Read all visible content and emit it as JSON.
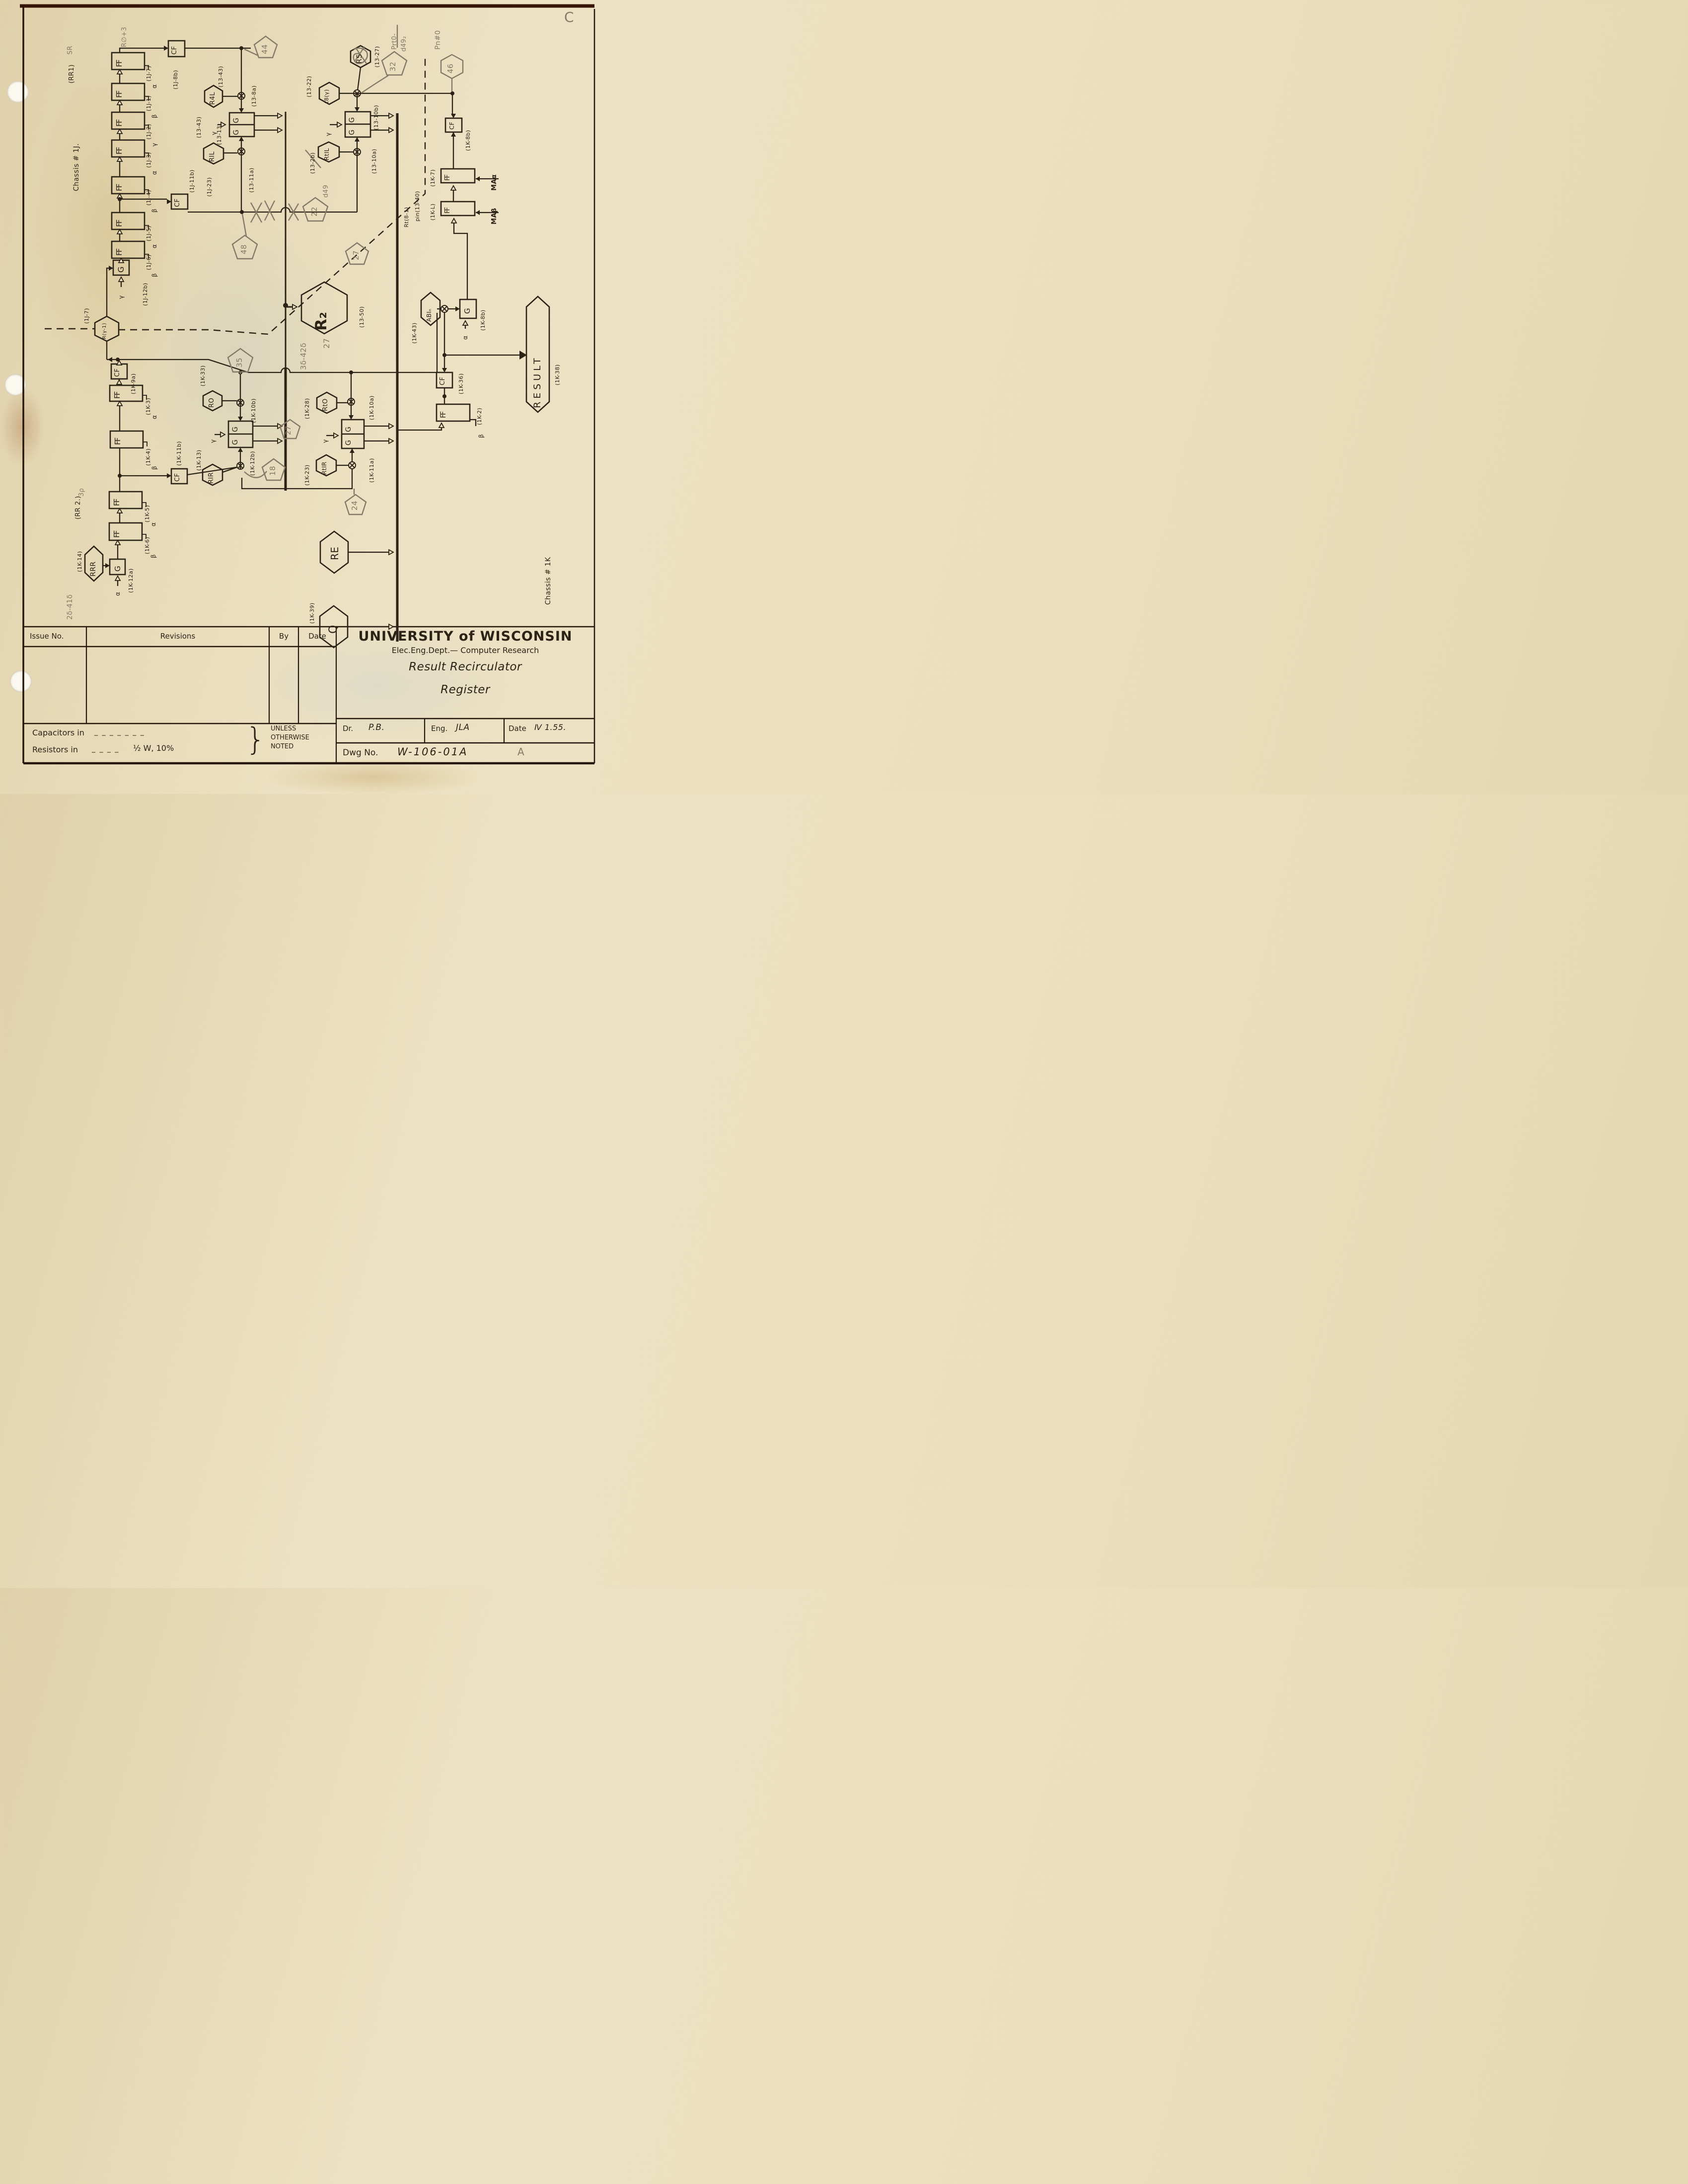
{
  "titleblock": {
    "org": "UNIVERSITY of WISCONSIN",
    "dept": "Elec.Eng.Dept.— Computer Research",
    "title1": "Result Recirculator",
    "title2": "Register",
    "issue": "Issue No.",
    "revisions": "Revisions",
    "by": "By",
    "date_col": "Date",
    "dr_label": "Dr.",
    "dr": "P.B.",
    "eng_label": "Eng.",
    "eng": "JLA",
    "date_label": "Date",
    "date": "Ⅳ 1.55.",
    "dwg_label": "Dwg No.",
    "dwg": "W-106-01A",
    "cap": "Capacitors in",
    "cap_dash": "_ _ _ _ _ _ _",
    "res": "Resistors in",
    "res_dash": "_ _ _ _",
    "res_val": "½ W, 10%",
    "brace": "}",
    "unless": "UNLESS",
    "otherwise": "OTHERWISE",
    "noted": "NOTED"
  },
  "chassis": {
    "top": "Chassis # 1J.",
    "bottom": "Chassis # 1K"
  },
  "blocks": {
    "ff": "FF",
    "cf": "CF",
    "g": "G"
  },
  "greek": {
    "a": "α",
    "b": "β",
    "g": "γ"
  },
  "flags": {
    "r4l": "R4L",
    "ril": "RIL",
    "rs": "RS",
    "t8g": "t8(γ)",
    "rtil": "RtIL",
    "r2": "R₂",
    "rg1": "R(γ-1)",
    "ro": "RO",
    "rir": "RIR",
    "rto": "RtO",
    "rtir": "RtIR",
    "abin": "ABIₙ",
    "rrr": "RRR",
    "re": "RE",
    "q": "Q",
    "result": "RESULT"
  },
  "pins": {
    "a1": "(1J-7)",
    "a2": "(1J-1)",
    "a3": "(1J-2)",
    "a4": "(1J-3)",
    "a5": "(1J-4)",
    "a6": "(1J-5)",
    "a7": "(1J-6)",
    "j8b": "(1J-8b)",
    "j12b": "(1J-12b)",
    "j11b": "(1J-11b)",
    "j23": "(1J-23)",
    "j7": "(1J-7)",
    "p43a": "(13-43)",
    "p43b": "(13-43)",
    "p13": "(13-13)",
    "p8a": "(13-8a)",
    "p11a": "(13-11a)",
    "p22": "(13-22)",
    "p27": "(13-27)",
    "p10b": "(13-10b)",
    "p10a": "(13-10a)",
    "p2b": "(13-2b)",
    "p50": "(13-50)",
    "rt81": "Rt(8-1)",
    "pin1340": "pin(13-40)",
    "k8bcf": "(1K-8b)",
    "k7": "(1K-7)",
    "kl": "(1K-L)",
    "maa": "MAα",
    "mab": "MAβ",
    "k43": "(1K-43)",
    "k8bg": "(1K-8b)",
    "k36": "(1K-36)",
    "k2": "(1K-2)",
    "k38": "(1K-38)",
    "k9a": "(1K-9a)",
    "k33": "(1K-33)",
    "k3": "(1K-3)",
    "k4": "(1K-4)",
    "k11b": "(1K-11b)",
    "k13": "(1K-13)",
    "k5": "(1K-5)",
    "k6": "(1K-6)",
    "k12a": "(1K-12a)",
    "k14": "(1K-14)",
    "k10b": "(1K-10b)",
    "k12b": "(1K-12b)",
    "k10a": "(1K-10a)",
    "k11a": "(1K-11a)",
    "k28": "(1K-28)",
    "k23": "(1K-23)",
    "k39": "(1K-39)",
    "rr1": "(RR1)",
    "rr2": "(RR 2.)"
  },
  "pencil": {
    "sr": "SR",
    "rd3": "R∅+3",
    "n44": "44",
    "n32": "32",
    "prt0": "Prt0-",
    "d492": "d49₂",
    "pn0": "Pn#0",
    "n46": "46",
    "n48": "48",
    "n22": "22",
    "d49": "d49",
    "n27a": "27",
    "n27b": "27",
    "n35": "35",
    "n18": "18",
    "n24": "24",
    "r2n": "27",
    "g3d": "3δ-42δ",
    "g2d": "2δ-41δ",
    "p3r": "3ρ",
    "a": "A",
    "c": "C"
  }
}
